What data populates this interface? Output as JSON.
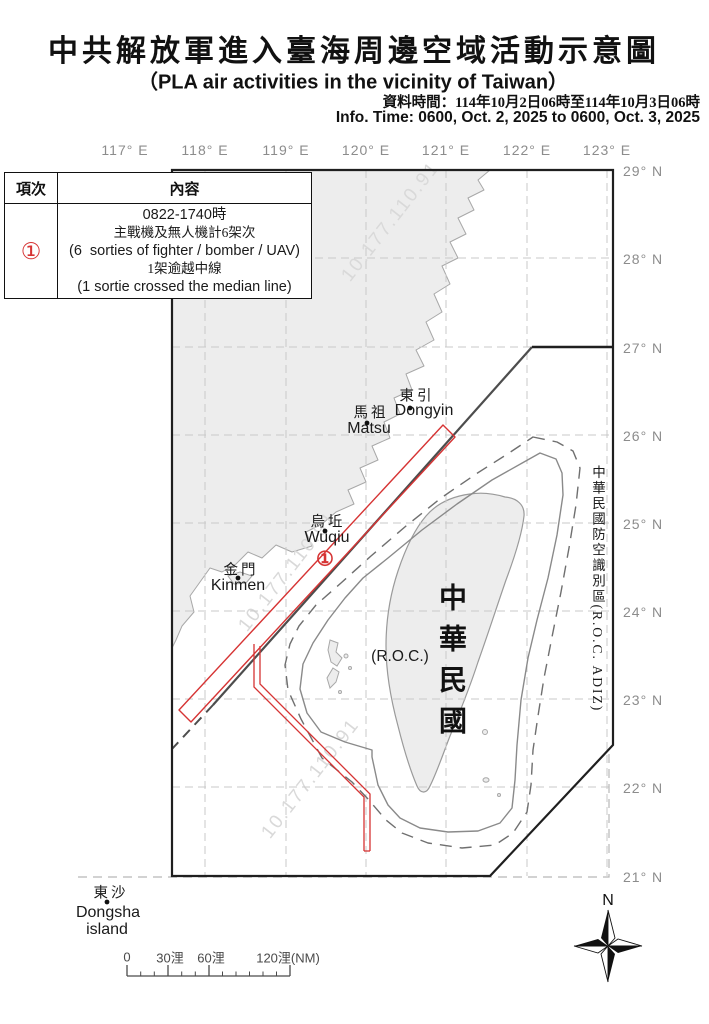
{
  "header": {
    "title_zh": "中共解放軍進入臺海周邊空域活動示意圖",
    "title_en": "（PLA air activities in the vicinity of Taiwan）",
    "info_time_zh": "資料時間：114年10月2日06時至114年10月3日06時",
    "info_time_en": "Info. Time: 0600, Oct. 2, 2025 to 0600, Oct. 3, 2025"
  },
  "activity_table": {
    "col_index": "項次",
    "col_content": "內容",
    "rows": [
      {
        "index_display": "①",
        "lines": [
          "0822-1740時",
          "主戰機及無人機計6架次",
          "(6  sorties of fighter / bomber / UAV)",
          "1架逾越中線",
          "(1 sortie crossed the median line)"
        ]
      }
    ]
  },
  "map": {
    "lon_labels": [
      "117° E",
      "118° E",
      "119° E",
      "120° E",
      "121° E",
      "122° E",
      "123° E"
    ],
    "lat_labels": [
      "29° N",
      "28° N",
      "27° N",
      "26° N",
      "25° N",
      "24° N",
      "23° N",
      "22° N",
      "21° N"
    ],
    "adiz_label": "中華民國防空識別區(R.O.C. ADIZ)",
    "taiwan_label": "中華民國",
    "roc_label": "(R.O.C.)",
    "places": {
      "dongyin": {
        "zh": "東引",
        "en": "Dongyin"
      },
      "matsu": {
        "zh": "馬祖",
        "en": "Matsu"
      },
      "wuqiu": {
        "zh": "烏坵",
        "en": "Wuqiu"
      },
      "kinmen": {
        "zh": "金門",
        "en": "Kinmen"
      },
      "dongsha": {
        "zh": "東沙",
        "en1": "Dongsha",
        "en2": "island"
      }
    },
    "route_marker": "①",
    "watermark": "10.177.110.91",
    "compass_label": "N",
    "scale_labels": [
      "0",
      "30浬",
      "60浬",
      "120浬(NM)"
    ],
    "colors": {
      "flight_path_red": "#d63434",
      "land_fill": "#ededed",
      "coast_stroke": "#a8a8a8",
      "grid": "#c9c9c9",
      "frame_black": "#1f1f1f",
      "median_line": "#4d4d4d",
      "zone_line": "#7d7d7d",
      "label_gray": "#8c8c8c",
      "watermark_gray": "#d9d9d9"
    }
  }
}
